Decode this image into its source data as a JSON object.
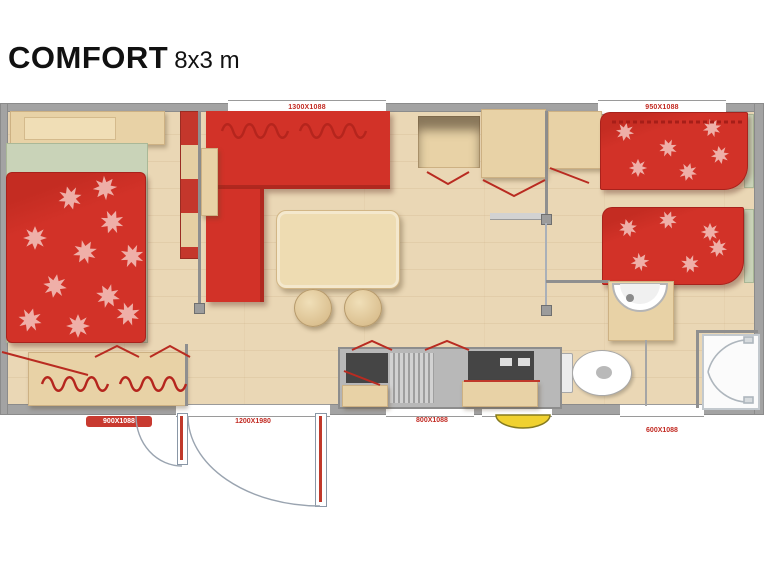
{
  "title": {
    "model": "COMFORT",
    "size": "8x3 m"
  },
  "plan": {
    "dimension_labels": {
      "top_window": "1300X1088",
      "top_right_window": "950X1088",
      "master_window": "900X1088",
      "entrance_door": "1200X1980",
      "kitchen_window": "800X1088",
      "twin_window": "600X1088"
    },
    "colors": {
      "fabric_red": "#d23228",
      "wood": "#e8d2a6",
      "floor": "#ead7b5",
      "wall": "#a3a3a3",
      "sheet_green": "#c9d3b8",
      "step_yellow": "#f0d12f",
      "label_red": "#c22a22"
    },
    "rooms": [
      "master-bedroom",
      "living-room",
      "kitchen",
      "wc",
      "bathroom",
      "twin-bedroom"
    ],
    "furniture": [
      "double-bed",
      "headboard",
      "wardrobe",
      "storage-bench",
      "corner-sofa",
      "side-table",
      "dining-table",
      "stool",
      "stool",
      "overhead-cabinet",
      "overhead-cabinet",
      "kitchen-counter",
      "sink",
      "drainer",
      "cooktop",
      "toilet",
      "washbasin",
      "shower-cabin",
      "single-bed",
      "single-bed"
    ]
  }
}
